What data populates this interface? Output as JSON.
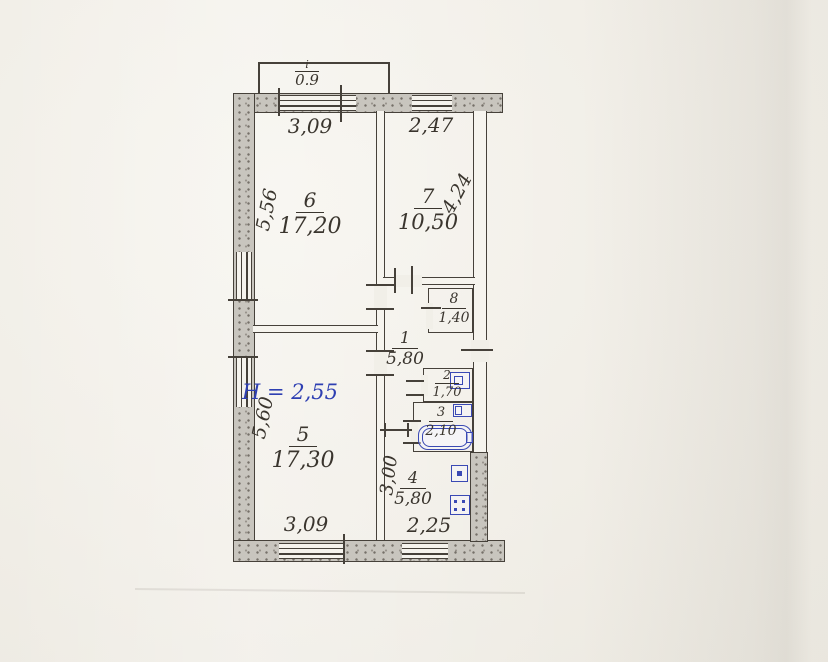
{
  "plan": {
    "title": "apartment-floor-plan",
    "height_note": "H = 2,55",
    "balcony": {
      "mark": "i",
      "depth": "0.9"
    },
    "rooms": [
      {
        "number": "6",
        "area": "17,20"
      },
      {
        "number": "7",
        "area": "10,50"
      },
      {
        "number": "8",
        "area": "1,40"
      },
      {
        "number": "1",
        "area": "5,80"
      },
      {
        "number": "2",
        "area": "1,70"
      },
      {
        "number": "3",
        "area": "2,10"
      },
      {
        "number": "4",
        "area": "5,80"
      },
      {
        "number": "5",
        "area": "17,30"
      }
    ],
    "dimensions": {
      "top_left": "3,09",
      "top_right": "2,47",
      "left_upper": "5,56",
      "left_lower": "5,60",
      "right_upper": "4,24",
      "kitchen_height": "3,00",
      "bottom_left": "3,09",
      "bottom_right": "2,25"
    },
    "colors": {
      "ink": "#46413a",
      "blue_ink": "#2e3fb2",
      "wall_fill": "#c8c5be",
      "paper": "#f1efe8"
    }
  }
}
